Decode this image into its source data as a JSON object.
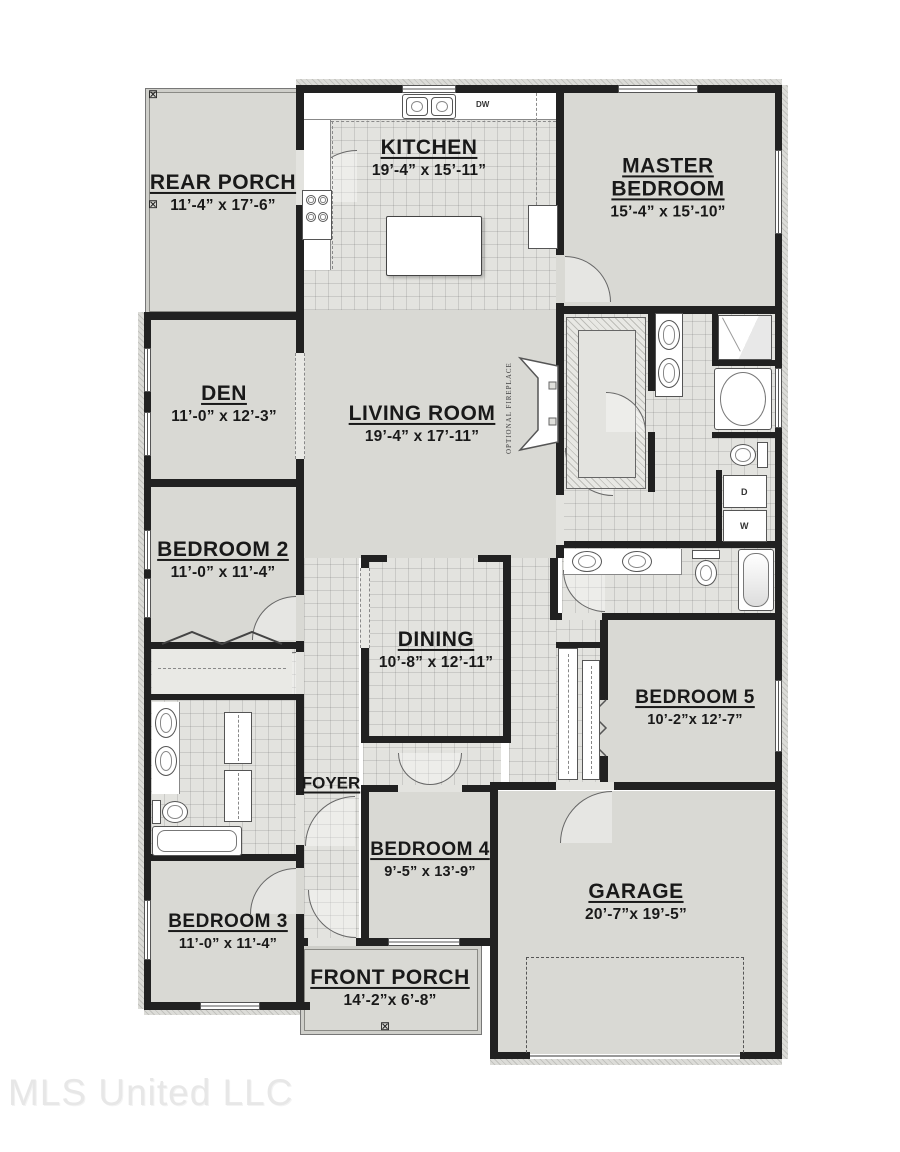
{
  "watermark": "MLS United LLC",
  "colors": {
    "wall": "#212121",
    "room_fill": "#d9d9d4",
    "tile_fill": "#e3e3df",
    "page_background": "#ffffff",
    "watermark_text": "#e7e7e7"
  },
  "icons": {
    "column_marker": "⊠"
  },
  "rooms": {
    "rear_porch": {
      "name": "REAR PORCH",
      "dims": "11’-4” x 17’-6”"
    },
    "kitchen": {
      "name": "KITCHEN",
      "dims": "19’-4” x 15’-11”"
    },
    "master_bedroom": {
      "name": "MASTER BEDROOM",
      "dims": "15’-4” x 15’-10”"
    },
    "den": {
      "name": "DEN",
      "dims": "11’-0” x 12’-3”"
    },
    "living_room": {
      "name": "LIVING ROOM",
      "dims": "19’-4” x 17’-11”"
    },
    "bedroom_2": {
      "name": "BEDROOM 2",
      "dims": "11’-0” x 11’-4”"
    },
    "dining": {
      "name": "DINING",
      "dims": "10’-8” x 12’-11”"
    },
    "bedroom_5": {
      "name": "BEDROOM 5",
      "dims": "10’-2”x 12’-7”"
    },
    "foyer": {
      "name": "FOYER"
    },
    "bedroom_4": {
      "name": "BEDROOM 4",
      "dims": "9’-5” x 13’-9”"
    },
    "garage": {
      "name": "GARAGE",
      "dims": "20’-7”x 19’-5”"
    },
    "bedroom_3": {
      "name": "BEDROOM 3",
      "dims": "11’-0” x 11’-4”"
    },
    "front_porch": {
      "name": "FRONT PORCH",
      "dims": "14’-2”x 6’-8”"
    }
  },
  "fixtures": {
    "dishwasher": "DW",
    "dryer": "D",
    "washer": "W",
    "fireplace_note": "OPTIONAL FIREPLACE"
  }
}
